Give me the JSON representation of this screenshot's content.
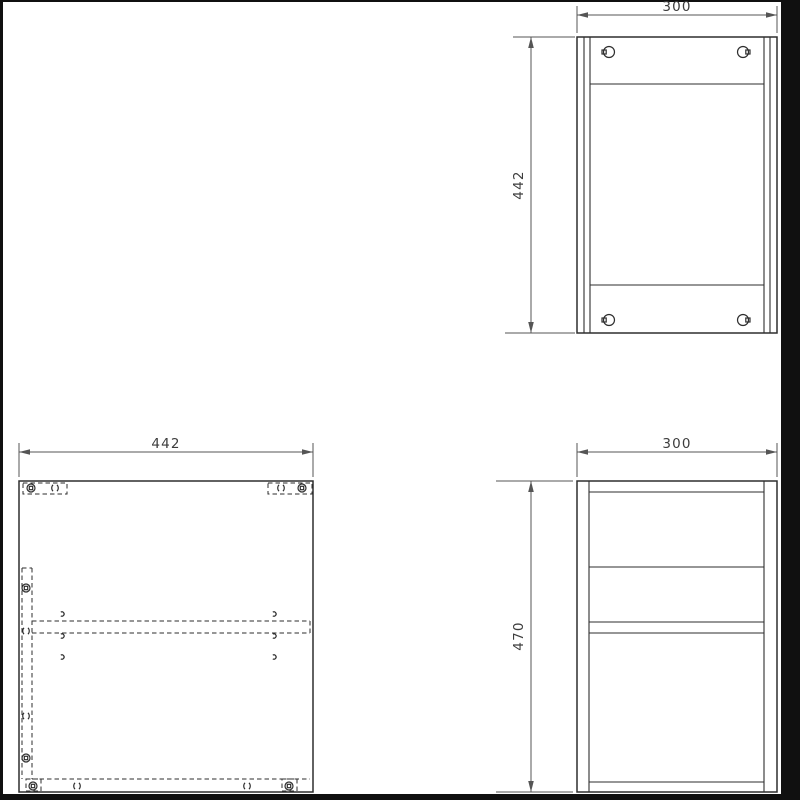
{
  "colors": {
    "frame": "#101010",
    "bg": "#ffffff",
    "line": "#2e2e2e",
    "dim": "#555555",
    "text": "#3d3d3d"
  },
  "views": {
    "front_view": {
      "width_dim": "300",
      "height_dim": "442"
    },
    "panel_top_view": {
      "width_dim": "442"
    },
    "side_view": {
      "width_dim": "300",
      "height_dim": "470"
    }
  }
}
